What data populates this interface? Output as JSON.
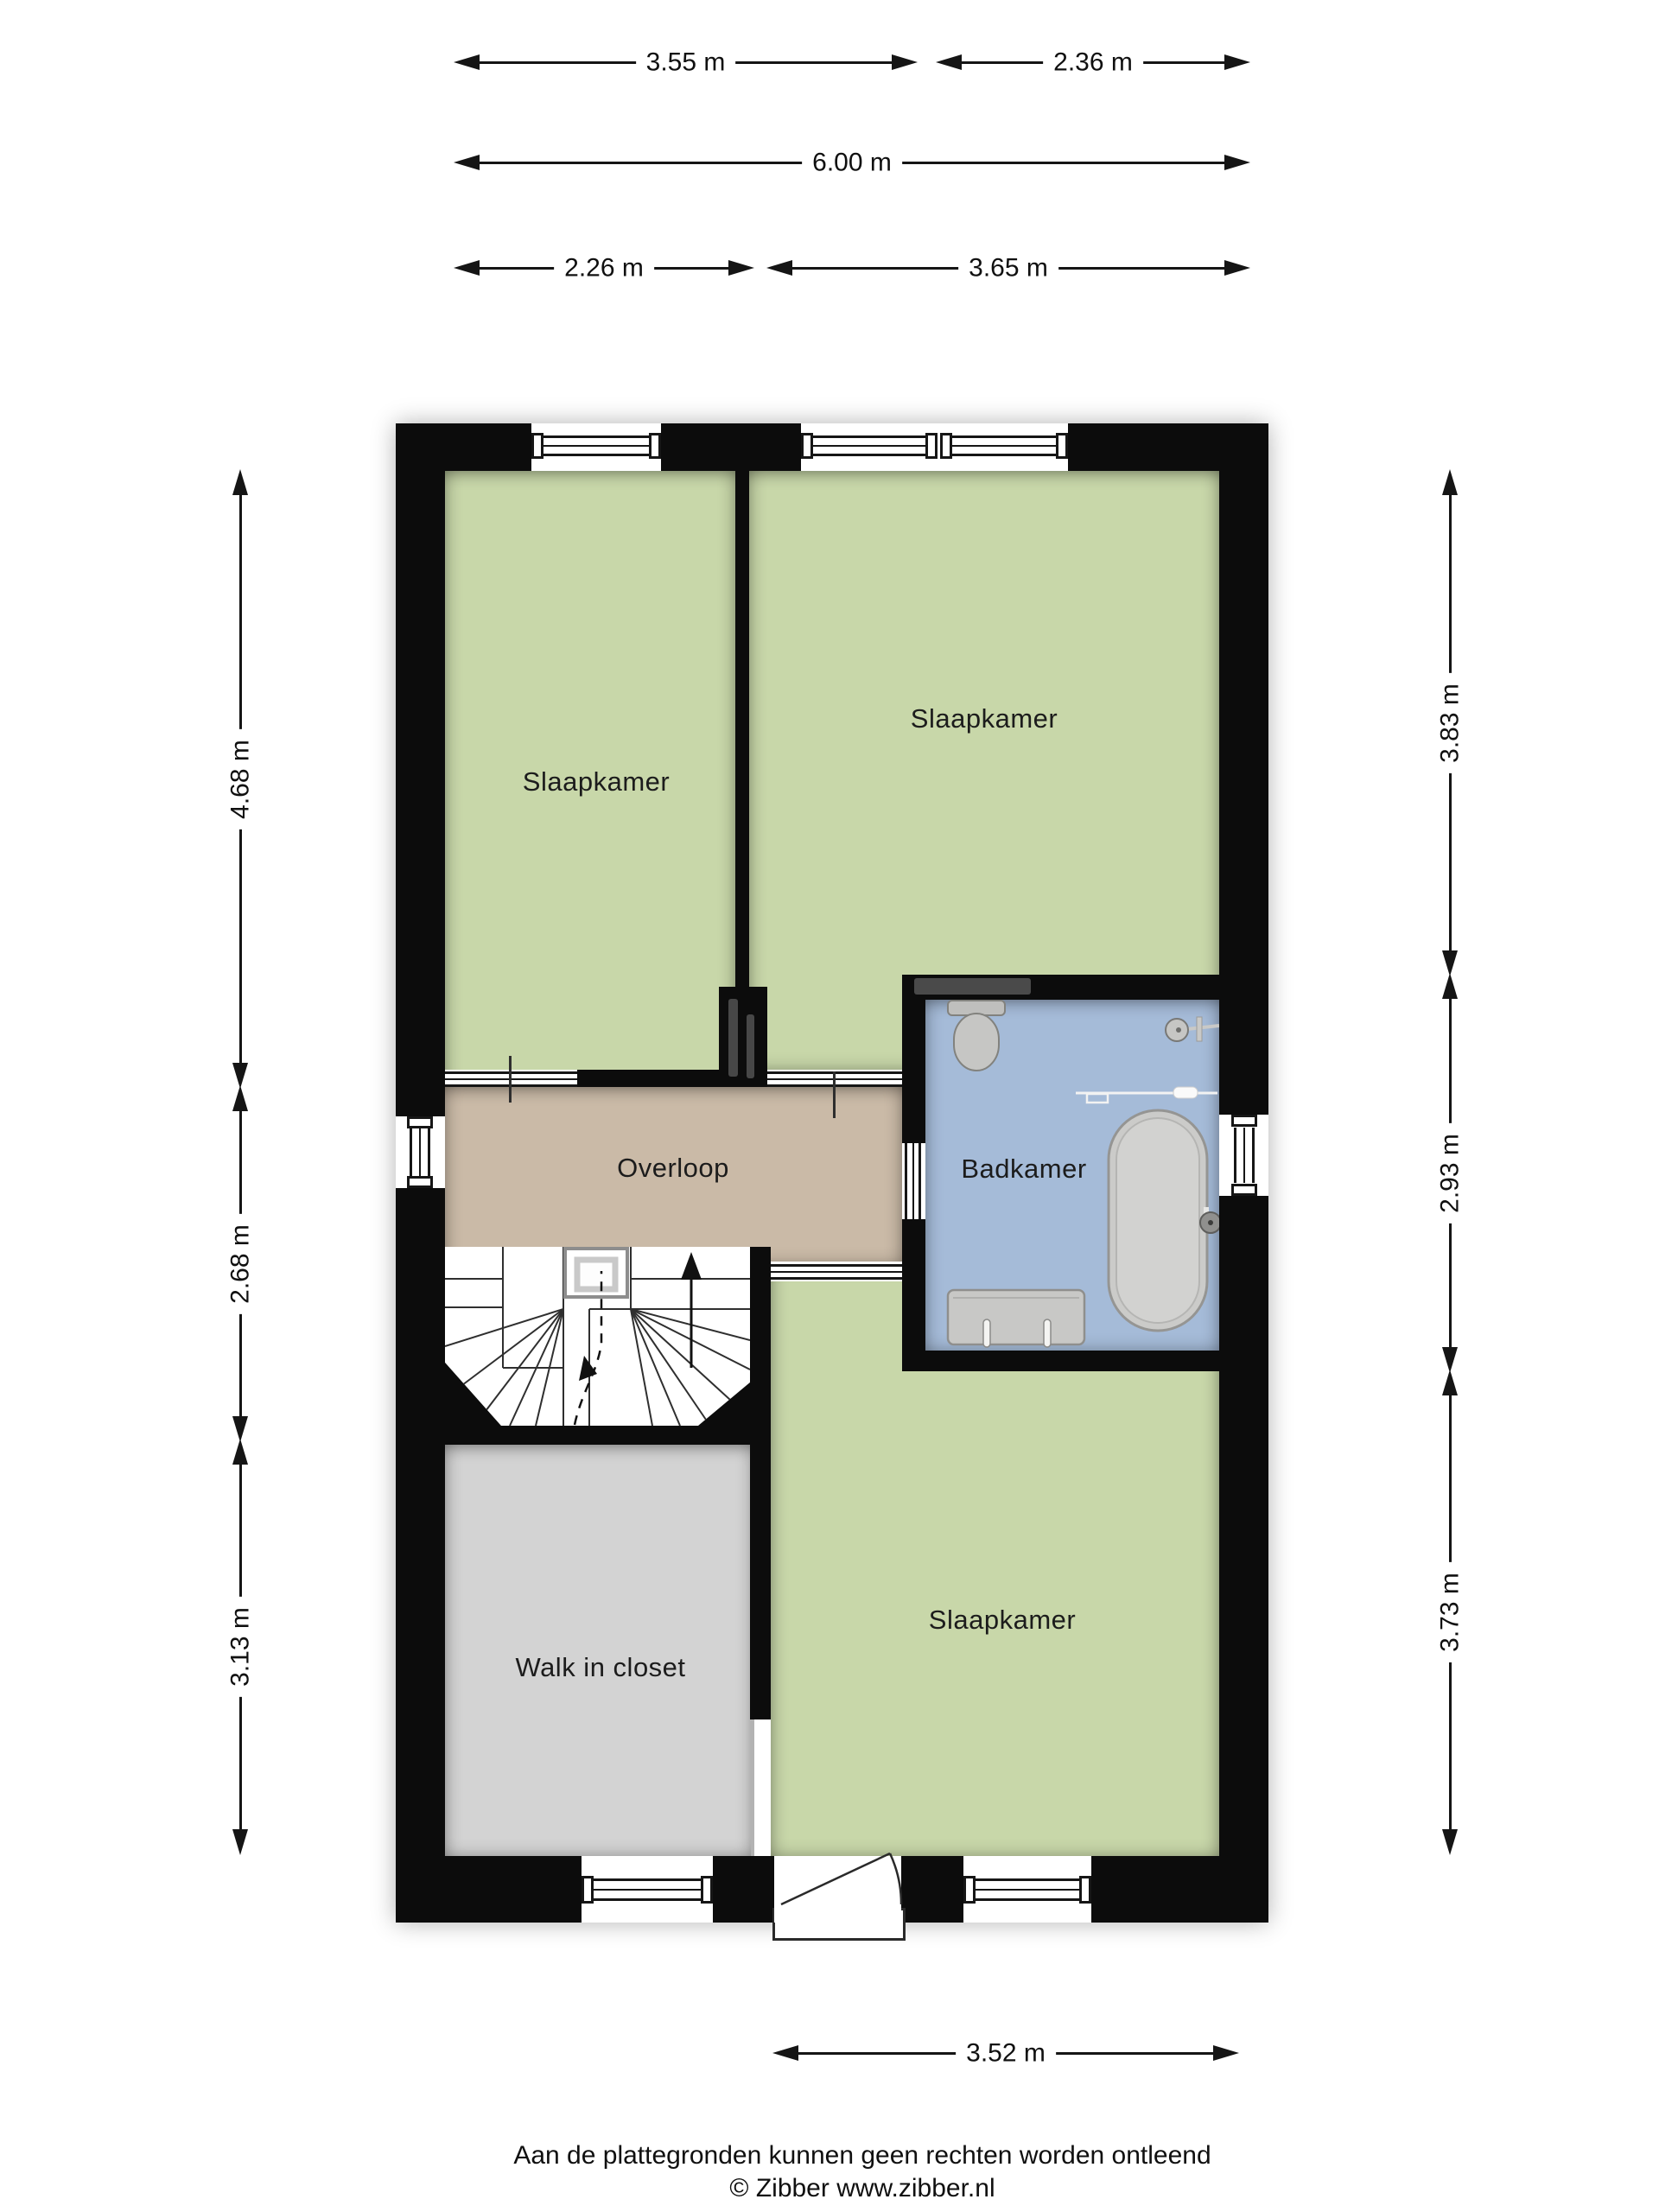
{
  "rooms": {
    "bedroom_tl": "Slaapkamer",
    "bedroom_tr": "Slaapkamer",
    "bedroom_bottom": "Slaapkamer",
    "landing": "Overloop",
    "bathroom": "Badkamer",
    "closet": "Walk in closet"
  },
  "dims": {
    "t1a": "3.55 m",
    "t1b": "2.36 m",
    "t2": "6.00 m",
    "t3a": "2.26 m",
    "t3b": "3.65 m",
    "l1": "4.68 m",
    "l2": "2.68 m",
    "l3": "3.13 m",
    "r1": "3.83 m",
    "r2": "2.93 m",
    "r3": "3.73 m",
    "b1": "3.52 m"
  },
  "footer": {
    "line1": "Aan de plattegronden kunnen geen rechten worden ontleend",
    "line2": "© Zibber www.zibber.nl"
  },
  "colors": {
    "room_green": "#c8d7a9",
    "landing_tan": "#cabaa7",
    "bathroom_blue": "#a5bbd8",
    "closet_gray": "#d3d3d3",
    "wall_black": "#0c0c0c",
    "line_dark": "#151515",
    "fixture_gray": "#c6c6c4"
  }
}
